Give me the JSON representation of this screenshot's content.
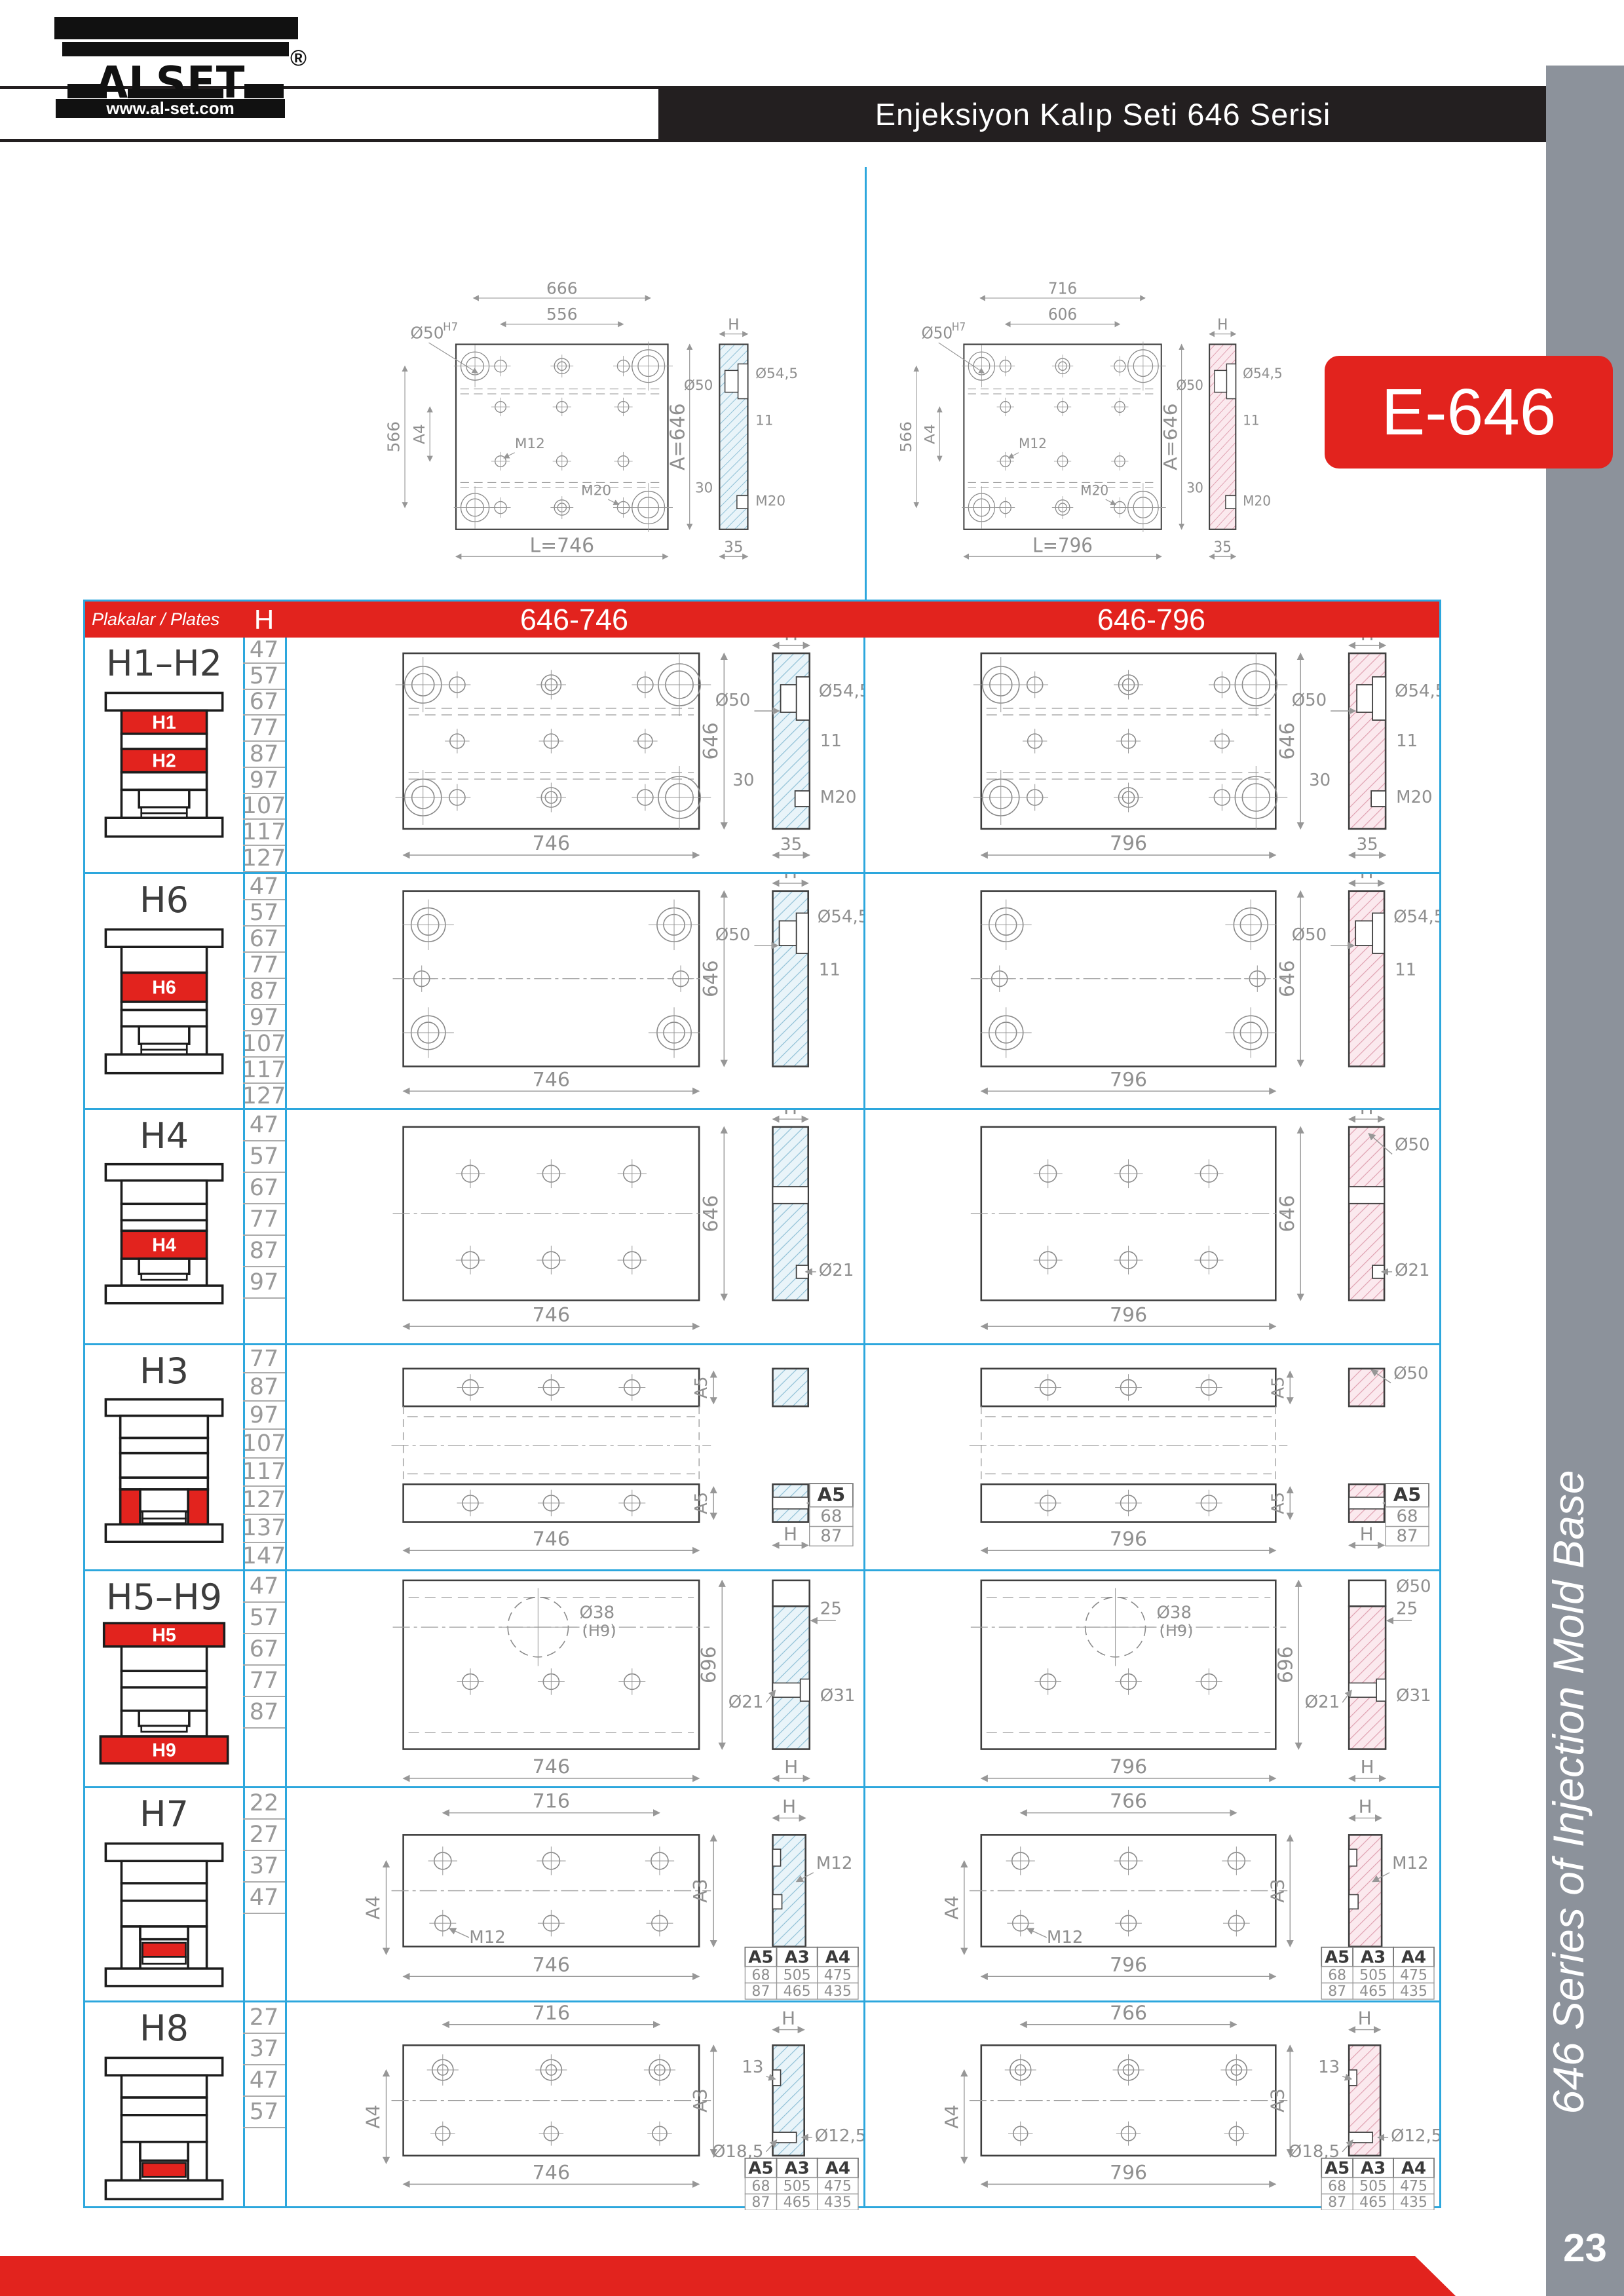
{
  "brand": {
    "name": "ALSET",
    "registered": "®",
    "website": "www.al-set.com"
  },
  "header": {
    "title": "Enjeksiyon Kalıp Seti 646 Serisi"
  },
  "badge": {
    "label": "E-646"
  },
  "sidebar": {
    "vertical_text": "646 Series of Injection Mold Base",
    "page_number": "23"
  },
  "colors": {
    "accent_red": "#e2231e",
    "border_cyan": "#2da7dd",
    "sidebar_gray": "#8c929b",
    "header_dark": "#231f20",
    "hatch_blue": "#e9f4f9",
    "hatch_pink": "#fbe9ee"
  },
  "top_drawings": [
    {
      "name": "646-746",
      "kind": "master",
      "hatch": "blue",
      "labels": {
        "top1": "666",
        "top2": "556",
        "fit": "Ø50",
        "fit_sup": "H7",
        "left1": "566",
        "left2": "A4",
        "m12": "M12",
        "m20": "M20",
        "length": "L=746",
        "height": "A=646",
        "h": "H",
        "d50": "Ø50",
        "d545": "Ø54,5",
        "d11": "11",
        "d30": "30",
        "m20s": "M20",
        "d35": "35"
      }
    },
    {
      "name": "646-796",
      "kind": "master",
      "hatch": "pink",
      "labels": {
        "top1": "716",
        "top2": "606",
        "fit": "Ø50",
        "fit_sup": "H7",
        "left1": "566",
        "left2": "A4",
        "m12": "M12",
        "m20": "M20",
        "length": "L=796",
        "height": "A=646",
        "h": "H",
        "d50": "Ø50",
        "d545": "Ø54,5",
        "d11": "11",
        "d30": "30",
        "m20s": "M20",
        "d35": "35"
      }
    }
  ],
  "table": {
    "header": {
      "plates": "Plakalar / Plates",
      "h": "H",
      "col1": "646-746",
      "col2": "646-796"
    },
    "rows": [
      {
        "id": "h1h2",
        "title": "H1–H2",
        "icon_labels": {
          "a": "H1",
          "b": "H2"
        },
        "h_values": [
          "47",
          "57",
          "67",
          "77",
          "87",
          "97",
          "107",
          "117",
          "127"
        ],
        "cells": [
          {
            "kind": "clamp",
            "hatch": "blue",
            "labels": {
              "height": "646",
              "length": "746",
              "h": "H",
              "d50": "Ø50",
              "d545": "Ø54,5",
              "d11": "11",
              "d30": "30",
              "m20": "M20",
              "d35": "35"
            }
          },
          {
            "kind": "clamp",
            "hatch": "pink",
            "labels": {
              "height": "646",
              "length": "796",
              "h": "H",
              "d50": "Ø50",
              "d545": "Ø54,5",
              "d11": "11",
              "d30": "30",
              "m20": "M20",
              "d35": "35"
            }
          }
        ]
      },
      {
        "id": "h6",
        "title": "H6",
        "icon_labels": {
          "a": "H6"
        },
        "h_values": [
          "47",
          "57",
          "67",
          "77",
          "87",
          "97",
          "107",
          "117",
          "127"
        ],
        "cells": [
          {
            "kind": "plain",
            "hatch": "blue",
            "labels": {
              "height": "646",
              "length": "746",
              "h": "H",
              "d50": "Ø50",
              "d545": "Ø54,5",
              "d11": "11"
            }
          },
          {
            "kind": "plain",
            "hatch": "pink",
            "labels": {
              "height": "646",
              "length": "796",
              "h": "H",
              "d50": "Ø50",
              "d545": "Ø54,5",
              "d11": "11"
            }
          }
        ]
      },
      {
        "id": "h4",
        "title": "H4",
        "icon_labels": {
          "a": "H4"
        },
        "h_values": [
          "47",
          "57",
          "67",
          "77",
          "87",
          "97"
        ],
        "cells": [
          {
            "kind": "six",
            "hatch": "blue",
            "labels": {
              "height": "646",
              "length": "746",
              "h": "H",
              "d21": "Ø21"
            }
          },
          {
            "kind": "six",
            "hatch": "pink",
            "labels": {
              "height": "646",
              "length": "796",
              "h": "H",
              "d50": "Ø50",
              "d21": "Ø21"
            }
          }
        ]
      },
      {
        "id": "h3",
        "title": "H3",
        "icon_labels": {},
        "h_values": [
          "77",
          "87",
          "97",
          "107",
          "117",
          "127",
          "137",
          "147"
        ],
        "cells": [
          {
            "kind": "rails",
            "hatch": "blue",
            "labels": {
              "length": "746",
              "rail": "A5",
              "h": "H",
              "d21": "Ø21"
            },
            "mini": {
              "header": "A5",
              "rows": [
                "68",
                "87"
              ]
            }
          },
          {
            "kind": "rails",
            "hatch": "pink",
            "labels": {
              "length": "796",
              "rail": "A5",
              "h": "H",
              "d50": "Ø50",
              "d21": "Ø21"
            },
            "mini": {
              "header": "A5",
              "rows": [
                "68",
                "87"
              ]
            }
          }
        ]
      },
      {
        "id": "h5h9",
        "title": "H5–H9",
        "icon_labels": {
          "a": "H5",
          "b": "H9"
        },
        "h_values": [
          "47",
          "57",
          "67",
          "77",
          "87"
        ],
        "cells": [
          {
            "kind": "center",
            "hatch": "blue",
            "labels": {
              "height": "696",
              "length": "746",
              "hole": "Ø38",
              "hole_fit": "(H9)",
              "h": "H",
              "d25": "25",
              "d21": "Ø21",
              "d31": "Ø31"
            }
          },
          {
            "kind": "center",
            "hatch": "pink",
            "labels": {
              "height": "696",
              "length": "796",
              "hole": "Ø38",
              "hole_fit": "(H9)",
              "h": "H",
              "d50": "Ø50",
              "d25": "25",
              "d21": "Ø21",
              "d31": "Ø31"
            }
          }
        ]
      },
      {
        "id": "h7",
        "title": "H7",
        "icon_labels": {},
        "h_values": [
          "22",
          "27",
          "37",
          "47"
        ],
        "cells": [
          {
            "kind": "bar7",
            "hatch": "blue",
            "labels": {
              "top": "716",
              "length": "746",
              "left": "A4",
              "right": "A3",
              "m12": "M12",
              "h": "H",
              "sm12": "M12"
            },
            "mini": {
              "headers": [
                "A5",
                "A3",
                "A4"
              ],
              "rows": [
                [
                  "68",
                  "505",
                  "475"
                ],
                [
                  "87",
                  "465",
                  "435"
                ]
              ]
            }
          },
          {
            "kind": "bar7",
            "hatch": "pink",
            "labels": {
              "top": "766",
              "length": "796",
              "left": "A4",
              "right": "A3",
              "m12": "M12",
              "h": "H",
              "sm12": "M12"
            },
            "mini": {
              "headers": [
                "A5",
                "A3",
                "A4"
              ],
              "rows": [
                [
                  "68",
                  "505",
                  "475"
                ],
                [
                  "87",
                  "465",
                  "435"
                ]
              ]
            }
          }
        ]
      },
      {
        "id": "h8",
        "title": "H8",
        "icon_labels": {},
        "h_values": [
          "27",
          "37",
          "47",
          "57"
        ],
        "cells": [
          {
            "kind": "bar8",
            "hatch": "blue",
            "labels": {
              "top": "716",
              "length": "746",
              "left": "A4",
              "right": "A3",
              "h": "H",
              "d13": "13",
              "d185": "Ø18,5",
              "d125": "Ø12,5"
            },
            "mini": {
              "headers": [
                "A5",
                "A3",
                "A4"
              ],
              "rows": [
                [
                  "68",
                  "505",
                  "475"
                ],
                [
                  "87",
                  "465",
                  "435"
                ]
              ]
            }
          },
          {
            "kind": "bar8",
            "hatch": "pink",
            "labels": {
              "top": "766",
              "length": "796",
              "left": "A4",
              "right": "A3",
              "h": "H",
              "d13": "13",
              "d185": "Ø18,5",
              "d125": "Ø12,5"
            },
            "mini": {
              "headers": [
                "A5",
                "A3",
                "A4"
              ],
              "rows": [
                [
                  "68",
                  "505",
                  "475"
                ],
                [
                  "87",
                  "465",
                  "435"
                ]
              ]
            }
          }
        ]
      }
    ]
  }
}
